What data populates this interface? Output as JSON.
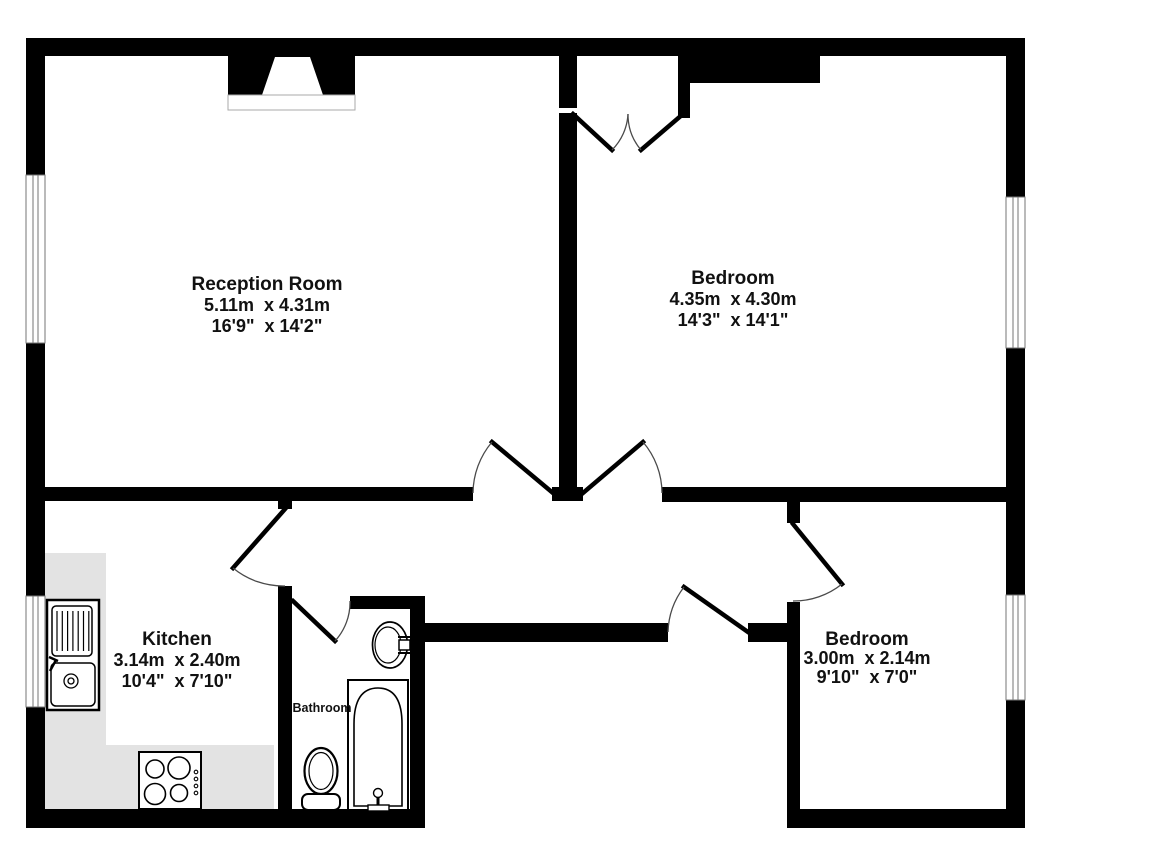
{
  "floorplan": {
    "wall_color": "#000000",
    "counter_color": "#e3e3e3",
    "text_color": "#111111",
    "window_frame_color": "#767676",
    "hearth_border_color": "#aaaaaa",
    "rooms": {
      "reception": {
        "name": "Reception Room",
        "metric": "5.11m  x 4.31m",
        "imperial": "16'9\"  x 14'2\""
      },
      "bedroom1": {
        "name": "Bedroom",
        "metric": "4.35m  x 4.30m",
        "imperial": "14'3\"  x 14'1\""
      },
      "kitchen": {
        "name": "Kitchen",
        "metric": "3.14m  x 2.40m",
        "imperial": "10'4\"  x 7'10\""
      },
      "bedroom2": {
        "name": "Bedroom",
        "metric": "3.00m  x 2.14m",
        "imperial": "9'10\"  x 7'0\""
      },
      "bathroom": {
        "name": "Bathroom"
      }
    }
  }
}
